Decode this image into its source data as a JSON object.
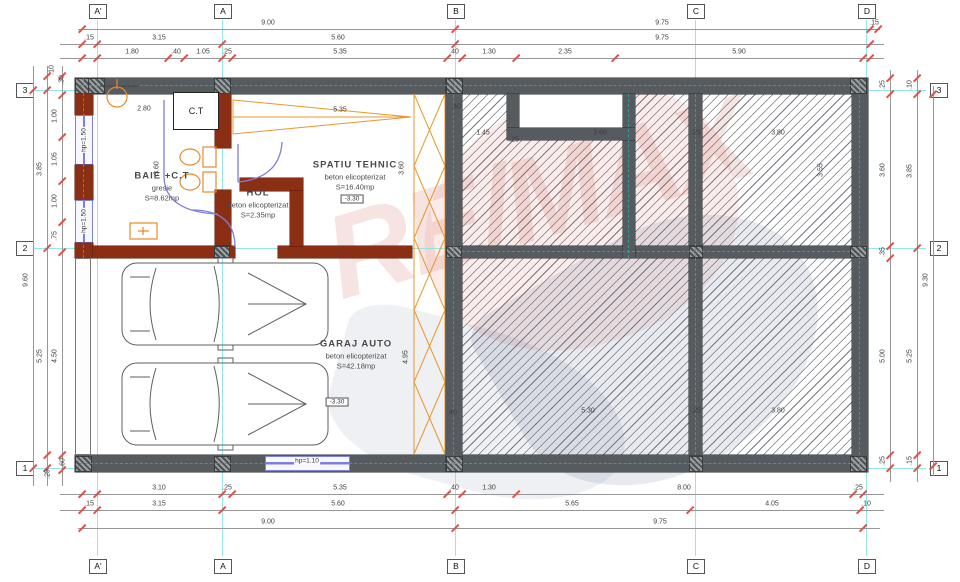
{
  "drawing": {
    "watermark": "RE/MAX",
    "ct_label": "C.T",
    "colors": {
      "wall_concrete": "#565b60",
      "wall_brick": "#8b2f14",
      "window": "#8080e0",
      "grid_line": "#8ae4e4",
      "dim_tick": "#e0514a",
      "hatch_line": "#73787d",
      "fixture": "#e8882e",
      "door": "#7d7de0",
      "watermark_red": "#d6453d",
      "watermark_blue": "#2e3d6e"
    },
    "grid": {
      "cols": [
        {
          "label": "A'",
          "x": 97
        },
        {
          "label": "A",
          "x": 222
        },
        {
          "label": "B",
          "x": 455
        },
        {
          "label": "C",
          "x": 695
        },
        {
          "label": "D",
          "x": 866
        }
      ],
      "rows": [
        {
          "label": "3",
          "y": 90
        },
        {
          "label": "2",
          "y": 248
        },
        {
          "label": "1",
          "y": 468
        }
      ]
    },
    "dim_chains": [
      {
        "o": "h",
        "y": 29,
        "x1": 78,
        "x2": 880,
        "ticks": [
          82,
          455,
          870,
          878
        ],
        "labels": [
          {
            "t": "9.00",
            "at": 268
          },
          {
            "t": "9.75",
            "at": 662
          },
          {
            "t": ".15",
            "at": 874
          }
        ]
      },
      {
        "o": "h",
        "y": 44,
        "x1": 60,
        "x2": 884,
        "ticks": [
          82,
          97,
          222,
          455,
          870
        ],
        "labels": [
          {
            "t": ".15",
            "at": 89
          },
          {
            "t": "3.15",
            "at": 159
          },
          {
            "t": "5.60",
            "at": 338
          },
          {
            "t": "9.75",
            "at": 662
          }
        ]
      },
      {
        "o": "h",
        "y": 58,
        "x1": 60,
        "x2": 884,
        "ticks": [
          82,
          97,
          168,
          184,
          222,
          232,
          447,
          462,
          516,
          615,
          863,
          870
        ],
        "labels": [
          {
            "t": "1.80",
            "at": 132
          },
          {
            "t": ".40",
            "at": 176
          },
          {
            "t": "1.05",
            "at": 203
          },
          {
            "t": ".25",
            "at": 227
          },
          {
            "t": "5.35",
            "at": 340
          },
          {
            "t": ".40",
            "at": 454
          },
          {
            "t": "1.30",
            "at": 489
          },
          {
            "t": "2.35",
            "at": 565
          },
          {
            "t": "5.90",
            "at": 739
          }
        ]
      },
      {
        "o": "h",
        "y": 494,
        "x1": 60,
        "x2": 884,
        "ticks": [
          82,
          97,
          222,
          232,
          447,
          462,
          516,
          853,
          863
        ],
        "labels": [
          {
            "t": "3.10",
            "at": 159
          },
          {
            "t": ".25",
            "at": 227
          },
          {
            "t": "5.35",
            "at": 340
          },
          {
            "t": ".40",
            "at": 454
          },
          {
            "t": "1.30",
            "at": 489
          },
          {
            "t": "8.00",
            "at": 684
          },
          {
            "t": ".25",
            "at": 858
          }
        ]
      },
      {
        "o": "h",
        "y": 510,
        "x1": 60,
        "x2": 884,
        "ticks": [
          82,
          97,
          222,
          455,
          690,
          860
        ],
        "labels": [
          {
            "t": ".15",
            "at": 89
          },
          {
            "t": "3.15",
            "at": 159
          },
          {
            "t": "5.60",
            "at": 338
          },
          {
            "t": "5.65",
            "at": 572
          },
          {
            "t": "4.05",
            "at": 772
          },
          {
            "t": ".10",
            "at": 866
          }
        ]
      },
      {
        "o": "h",
        "y": 528,
        "x1": 78,
        "x2": 880,
        "ticks": [
          82,
          455,
          863
        ],
        "labels": [
          {
            "t": "9.00",
            "at": 268
          },
          {
            "t": "9.75",
            "at": 660
          }
        ]
      },
      {
        "o": "v",
        "x": 33,
        "y1": 66,
        "y2": 486,
        "ticks": [
          90,
          468
        ],
        "labels": [
          {
            "t": "9.60",
            "at": 280
          }
        ]
      },
      {
        "o": "v",
        "x": 47,
        "y1": 66,
        "y2": 486,
        "ticks": [
          76,
          90,
          248,
          455,
          468
        ],
        "labels": [
          {
            "t": "3.85",
            "at": 169
          },
          {
            "t": "5.25",
            "at": 356
          }
        ]
      },
      {
        "o": "v",
        "x": 62,
        "y1": 66,
        "y2": 486,
        "ticks": [
          76,
          95,
          137,
          181,
          222,
          252,
          455,
          470
        ],
        "labels": [
          {
            "t": "1.00",
            "at": 116
          },
          {
            "t": "1.05",
            "at": 159
          },
          {
            "t": "1.00",
            "at": 201
          },
          {
            "t": ".75",
            "at": 236
          },
          {
            "t": "4.50",
            "at": 356
          }
        ]
      },
      {
        "o": "v",
        "x": 890,
        "y1": 70,
        "y2": 482,
        "ticks": [
          78,
          94,
          246,
          258,
          455,
          468
        ],
        "labels": [
          {
            "t": ".25",
            "at": 85
          },
          {
            "t": "3.60",
            "at": 170
          },
          {
            "t": ".35",
            "at": 252
          },
          {
            "t": "5.00",
            "at": 356
          },
          {
            "t": ".25",
            "at": 461
          }
        ]
      },
      {
        "o": "v",
        "x": 917,
        "y1": 70,
        "y2": 482,
        "ticks": [
          78,
          94,
          248,
          455,
          468
        ],
        "labels": [
          {
            "t": ".10",
            "at": 85
          },
          {
            "t": "3.85",
            "at": 171
          },
          {
            "t": "5.25",
            "at": 356
          },
          {
            "t": ".15",
            "at": 461
          }
        ]
      },
      {
        "o": "v",
        "x": 933,
        "y1": 86,
        "y2": 476,
        "ticks": [
          94,
          466
        ],
        "labels": [
          {
            "t": "9.30",
            "at": 280
          }
        ]
      }
    ],
    "interior_dims": [
      {
        "t": "2.80",
        "x": 144,
        "y": 109
      },
      {
        "t": "3.60",
        "x": 157,
        "y": 168,
        "r": 1
      },
      {
        "t": "5.35",
        "x": 340,
        "y": 110
      },
      {
        "t": "3.60",
        "x": 402,
        "y": 168,
        "r": 1
      },
      {
        "t": "4.95",
        "x": 406,
        "y": 357,
        "r": 1
      },
      {
        "t": ".40",
        "x": 456,
        "y": 107
      },
      {
        "t": "1.45",
        "x": 483,
        "y": 133
      },
      {
        "t": ".25",
        "x": 514,
        "y": 140
      },
      {
        "t": "3.60",
        "x": 600,
        "y": 133
      },
      {
        "t": ".25",
        "x": 696,
        "y": 133
      },
      {
        "t": "3.80",
        "x": 778,
        "y": 133
      },
      {
        "t": "3.55",
        "x": 821,
        "y": 170,
        "r": 1
      },
      {
        "t": ".40",
        "x": 452,
        "y": 413
      },
      {
        "t": "5.30",
        "x": 588,
        "y": 411
      },
      {
        "t": ".25",
        "x": 696,
        "y": 411
      },
      {
        "t": "3.80",
        "x": 778,
        "y": 411
      },
      {
        "t": ".10",
        "x": 52,
        "y": 70,
        "r": 1
      },
      {
        "t": ".30",
        "x": 62,
        "y": 80,
        "r": 1
      },
      {
        "t": ".60",
        "x": 63,
        "y": 463,
        "r": 1
      },
      {
        "t": ".25",
        "x": 48,
        "y": 474,
        "r": 1
      }
    ],
    "window_labels": [
      {
        "t": "hp=1.50",
        "x": 84,
        "y": 140,
        "r": 1
      },
      {
        "t": "hp=1.50",
        "x": 84,
        "y": 221,
        "r": 1
      },
      {
        "t": "hp=1.10",
        "x": 307,
        "y": 461
      }
    ],
    "rooms": [
      {
        "name": "BAIE +C.T",
        "sub1": "gresie",
        "sub2": "S=8.62mp",
        "x": 162,
        "y": 176
      },
      {
        "name": "HOL",
        "sub1": "beton elicopterizat",
        "sub2": "S=2.35mp",
        "x": 258,
        "y": 193
      },
      {
        "name": "SPATIU TEHNIC",
        "sub1": "beton elicopterizat",
        "sub2": "S=16.40mp",
        "x": 355,
        "y": 165,
        "elev": "-3.30",
        "ex": 352,
        "ey": 199
      },
      {
        "name": "GARAJ AUTO",
        "sub1": "beton elicopterizat",
        "sub2": "S=42.18mp",
        "x": 356,
        "y": 344,
        "elev": "-3.30",
        "ex": 337,
        "ey": 402
      }
    ]
  }
}
